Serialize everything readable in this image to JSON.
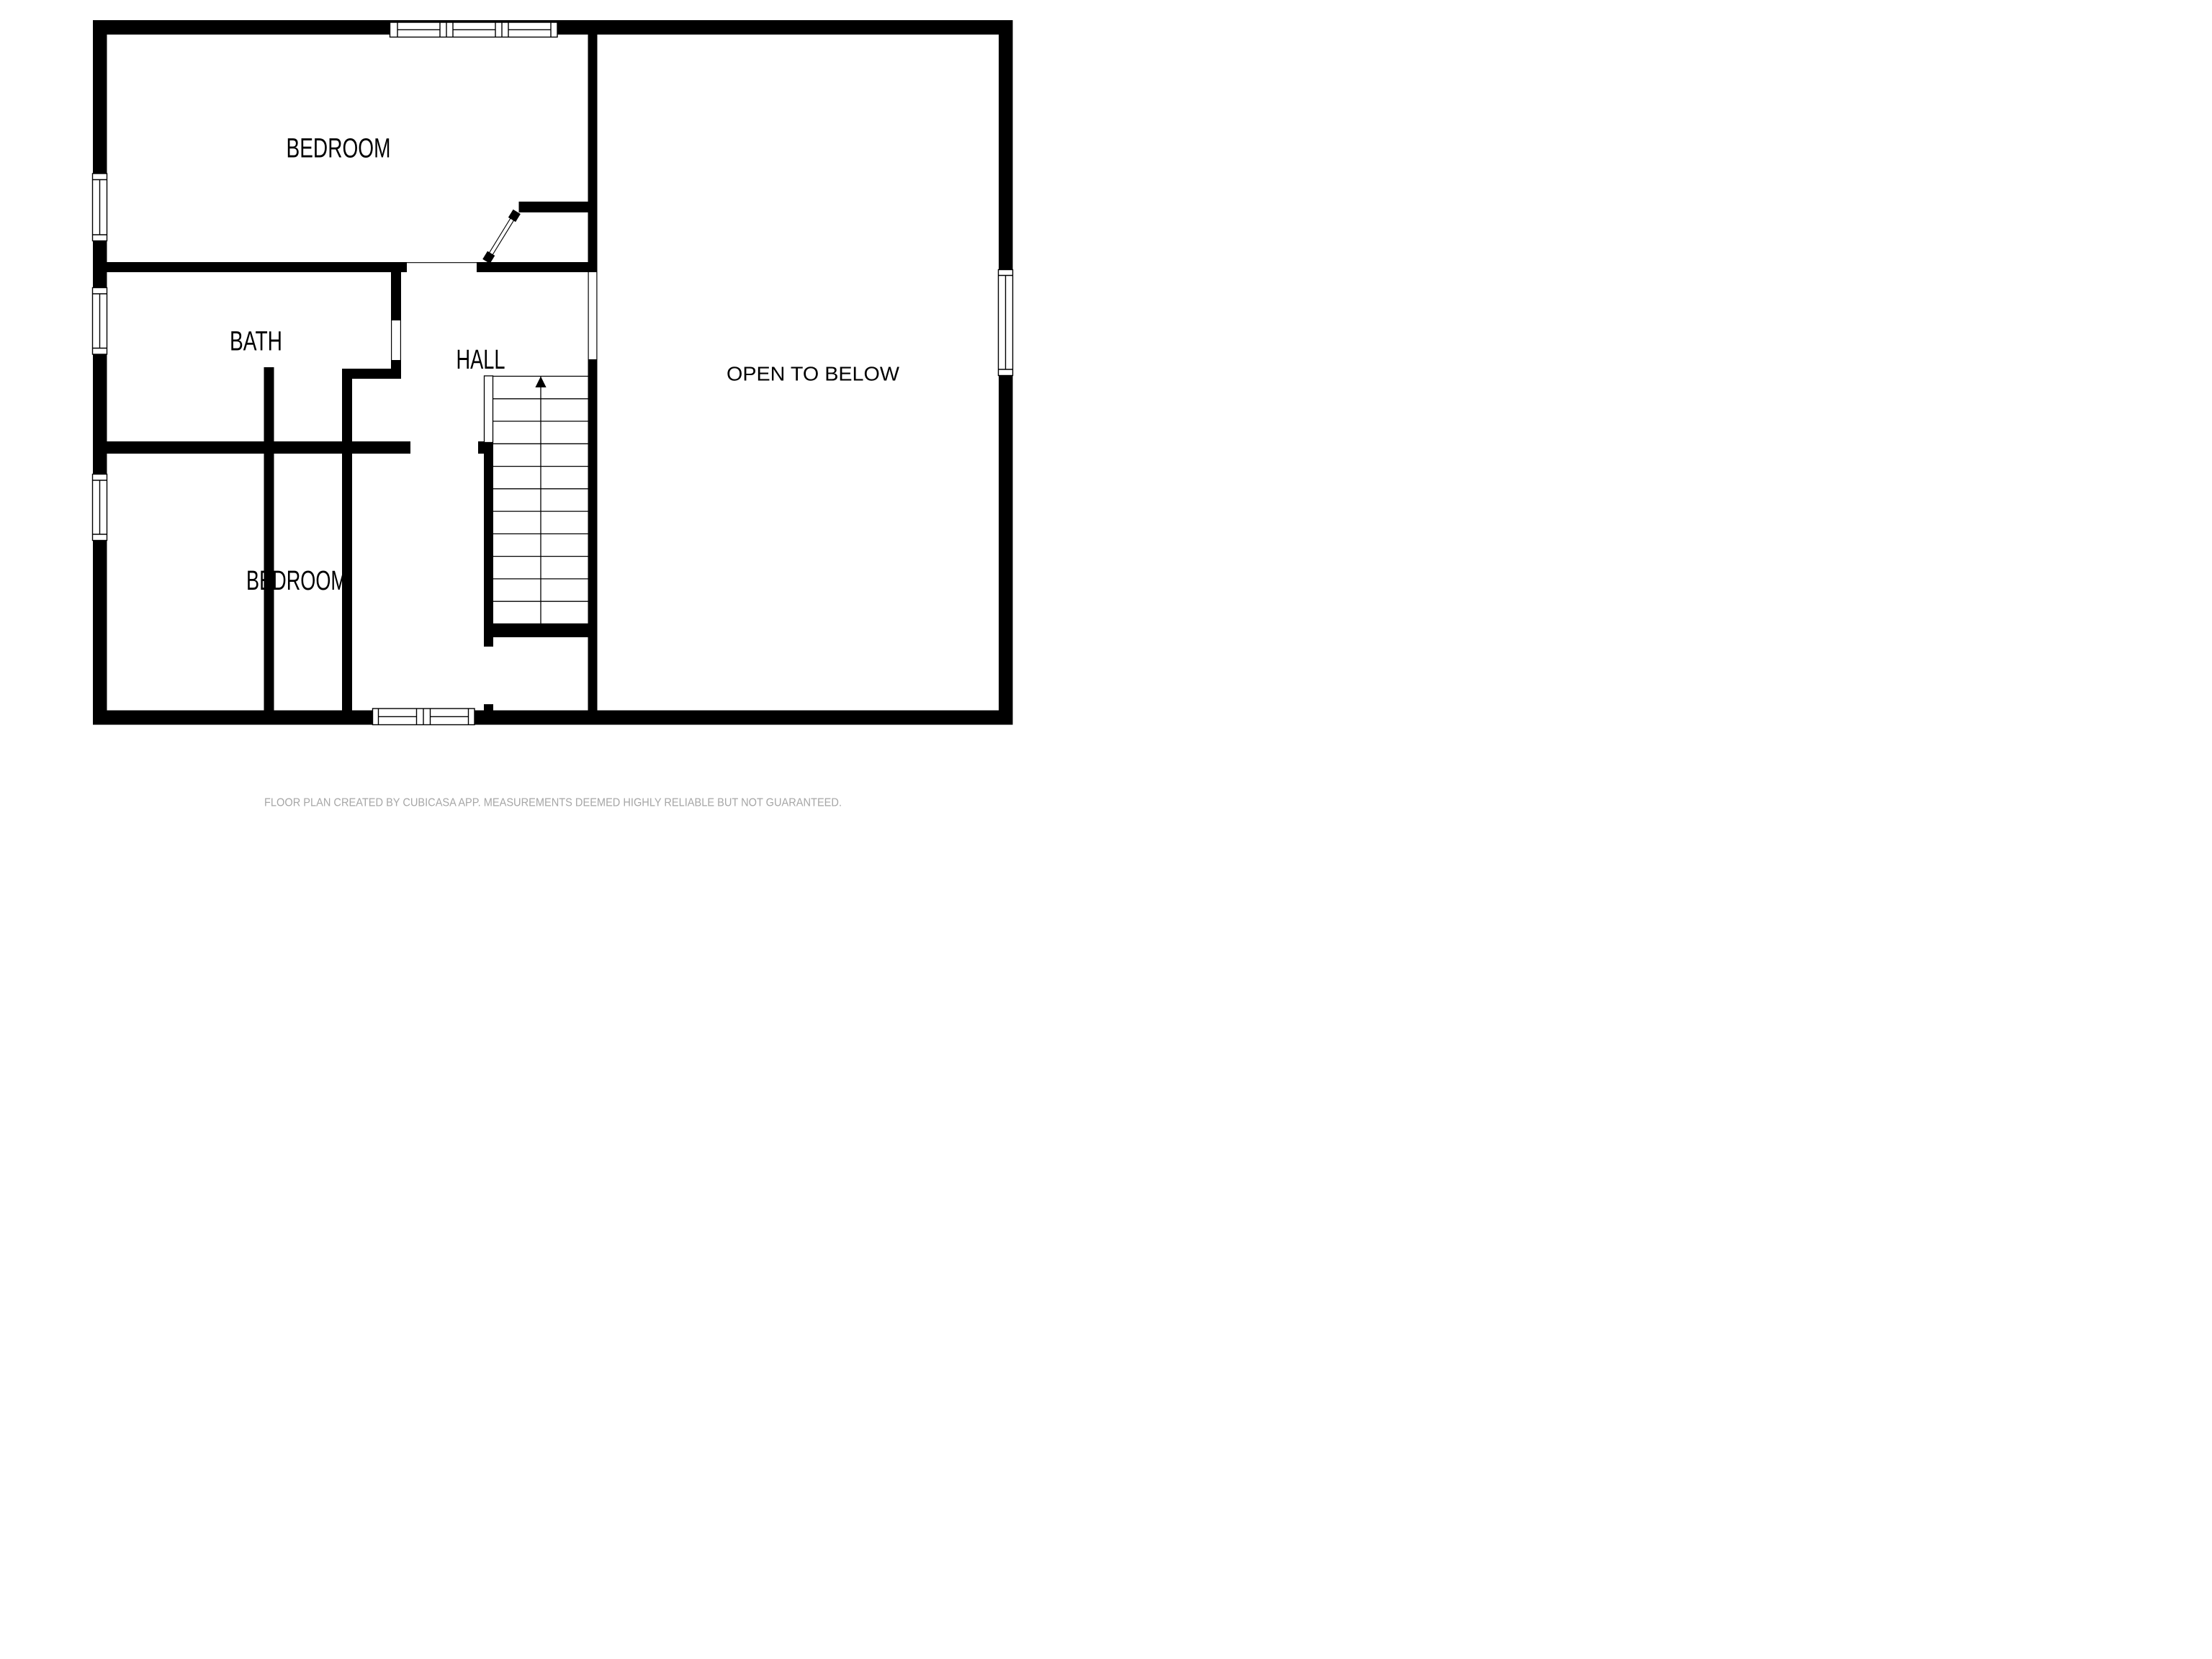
{
  "page": {
    "background": "#ffffff"
  },
  "floor_plan": {
    "rooms": [
      {
        "id": "bedroom_top",
        "label": "BEDROOM"
      },
      {
        "id": "bath",
        "label": "BATH"
      },
      {
        "id": "hall",
        "label": "HALL"
      },
      {
        "id": "open_to_below",
        "label": "OPEN TO BELOW"
      },
      {
        "id": "bedroom_bottom",
        "label": "BEDROOM"
      }
    ],
    "stairs": {
      "direction": "up",
      "tread_count": 11
    },
    "symbols": {
      "windows": 6,
      "swing_doors": 1
    },
    "colors": {
      "wall": "#000000",
      "floor": "#ffffff",
      "label_text": "#000000",
      "disclaimer_text": "#a6a6a6"
    }
  },
  "footer": {
    "disclaimer": "FLOOR PLAN CREATED BY CUBICASA APP. MEASUREMENTS DEEMED HIGHLY RELIABLE BUT NOT GUARANTEED."
  }
}
